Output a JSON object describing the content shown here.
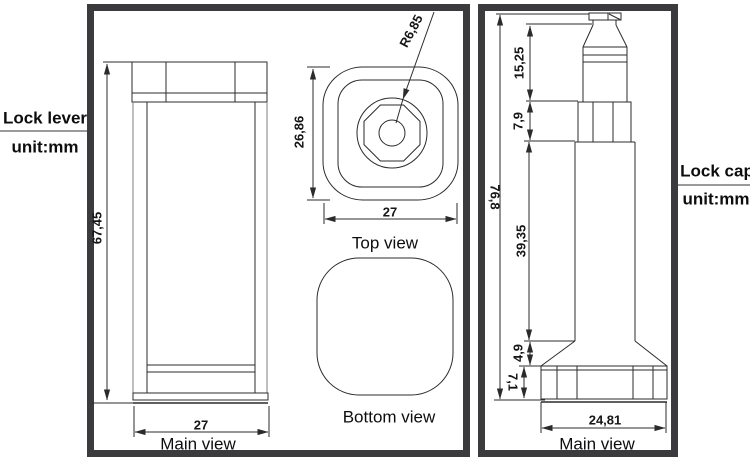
{
  "left_annotation": {
    "title": "Lock lever",
    "unit": "unit:mm"
  },
  "right_annotation": {
    "title": "Lock cap",
    "unit": "unit:mm"
  },
  "lock_lever": {
    "main_view": {
      "label": "Main view",
      "height_dim": "67,45",
      "width_dim": "27"
    },
    "top_view": {
      "label": "Top view",
      "height_dim": "26,86",
      "width_dim": "27",
      "radius_dim": "R6,85"
    },
    "bottom_view": {
      "label": "Bottom view"
    }
  },
  "lock_cap": {
    "main_view": {
      "label": "Main view",
      "total_height_dim": "76,8",
      "top_section_dim": "15,25",
      "collar_section_dim": "7,9",
      "body_section_dim": "39,35",
      "flare_section_dim": "4,9",
      "base_section_dim": "7,1",
      "base_width_dim": "24,81"
    }
  },
  "colors": {
    "line": "#2b2b2b",
    "panel_border": "#3b3b3d",
    "background": "#ffffff"
  }
}
